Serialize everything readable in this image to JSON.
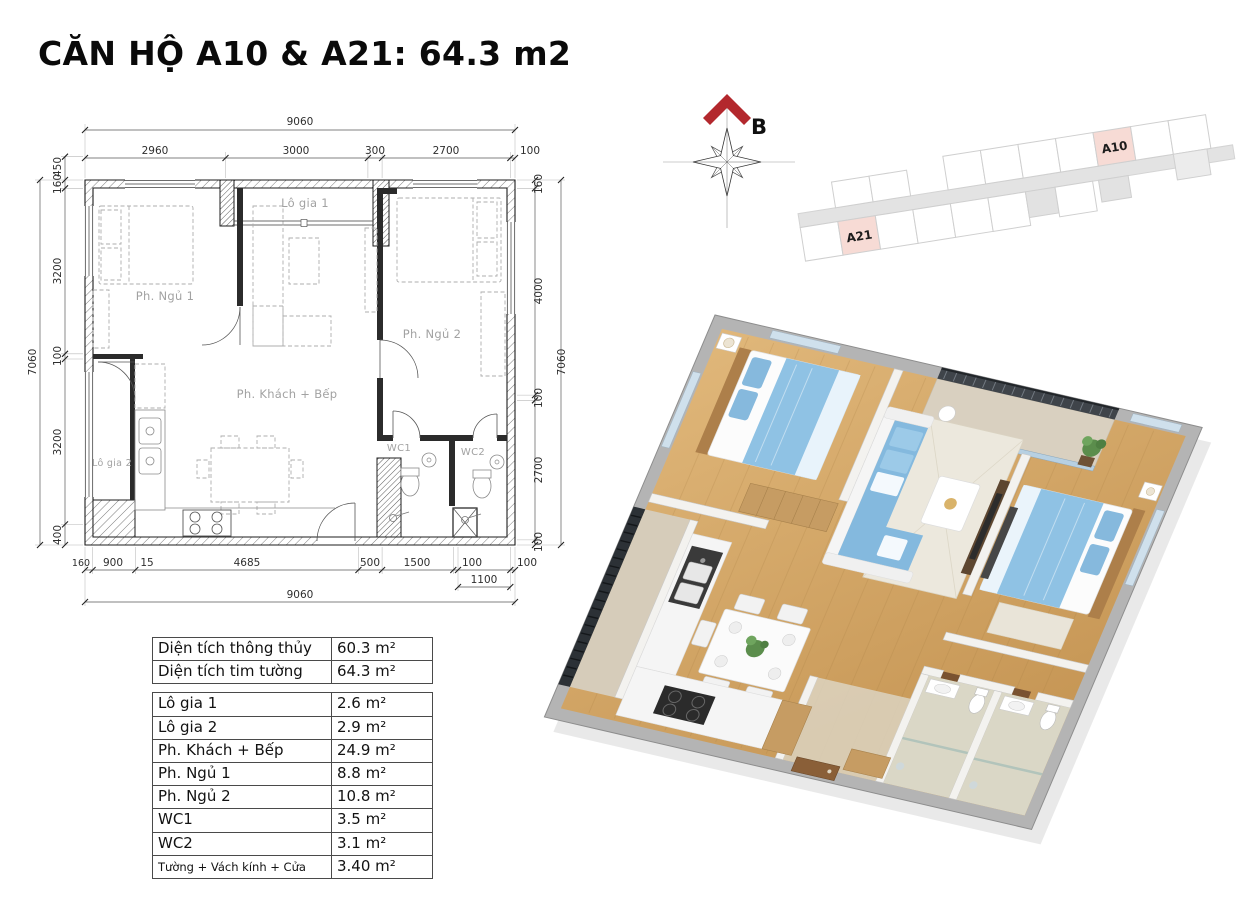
{
  "title": "CĂN HỘ A10 & A21: 64.3 m2",
  "compass": {
    "north_label": "B"
  },
  "key_plan": {
    "unit_top": "A10",
    "unit_bottom": "A21"
  },
  "floor_plan": {
    "room_labels": {
      "lo_gia_1": "Lô gia 1",
      "ph_ngu_1": "Ph. Ngủ 1",
      "ph_ngu_2": "Ph. Ngủ 2",
      "ph_khach_bep": "Ph. Khách + Bếp",
      "lo_gia_2": "Lô gia 2",
      "wc1": "WC1",
      "wc2": "WC2"
    },
    "dims": {
      "top_total": "9060",
      "top": [
        "2960",
        "3000",
        "300",
        "2700",
        "100"
      ],
      "left_total": "7060",
      "left": [
        "450",
        "160",
        "3200",
        "100",
        "3200",
        "400"
      ],
      "right_total": "7060",
      "right": [
        "160",
        "4000",
        "100",
        "2700",
        "100"
      ],
      "bottom": [
        "160",
        "900",
        "15",
        "4685",
        "500",
        "1500",
        "100",
        "100"
      ],
      "bottom_sub": "1100",
      "bottom_total": "9060"
    }
  },
  "area_table": {
    "summary": [
      {
        "label": "Diện tích thông thủy",
        "value": "60.3 m²"
      },
      {
        "label": "Diện tích tim tường",
        "value": "64.3 m²"
      }
    ],
    "rooms": [
      {
        "label": "Lô gia 1",
        "value": "2.6 m²"
      },
      {
        "label": "Lô gia 2",
        "value": "2.9 m²"
      },
      {
        "label": "Ph. Khách + Bếp",
        "value": "24.9 m²"
      },
      {
        "label": "Ph. Ngủ 1",
        "value": "8.8 m²"
      },
      {
        "label": "Ph. Ngủ 2",
        "value": "10.8 m²"
      },
      {
        "label": "WC1",
        "value": "3.5 m²"
      },
      {
        "label": "WC2",
        "value": "3.1 m²"
      },
      {
        "label": "Tường + Vách kính + Cửa",
        "value": "3.40 m²"
      }
    ]
  },
  "colors": {
    "highlight_unit": "#f7dbd5",
    "north_arrow": "#b3282d",
    "wood_floor": "#cf9f5f",
    "furniture_blue": "#86b9dd",
    "railing_dark": "#3f444a"
  }
}
